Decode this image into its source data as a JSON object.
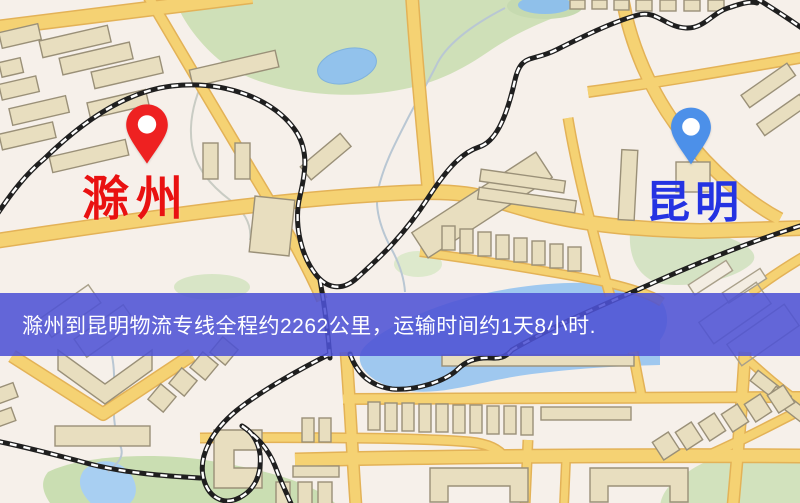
{
  "page": {
    "width_px": 800,
    "height_px": 503,
    "kind": "logistics route map"
  },
  "markers": [
    {
      "role": "origin",
      "label": "滁州",
      "pin_color": "#ee2121",
      "label_color": "#e91111"
    },
    {
      "role": "destination",
      "label": "昆明",
      "pin_color": "#4c90e9",
      "label_color": "#2433e2"
    }
  ],
  "banner": {
    "text": "滁州到昆明物流专线全程约2262公里，运输时间约1天8小时.",
    "background_color": "#4d51d4",
    "text_color": "#ffffff"
  },
  "route": {
    "origin": "滁州",
    "destination": "昆明",
    "distance_text": "约2262公里",
    "transit_time_text": "约1天8小时"
  },
  "map_palette": {
    "base": "#f6f0ea",
    "road_fill": "#f5d273",
    "road_casing": "#e3b257",
    "building_fill": "#e8debf",
    "building_stroke": "#9a9078",
    "park_green": "#cfe0b8",
    "water_blue": "#9fc8ef",
    "railway_dark": "#1f1f1f",
    "railway_dash": "#ffffff"
  }
}
